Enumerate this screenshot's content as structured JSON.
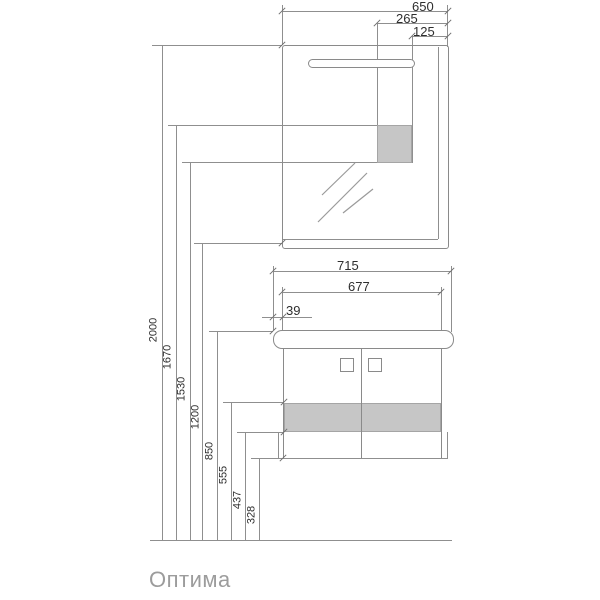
{
  "title": "Оптима",
  "colors": {
    "line": "#8f8f8f",
    "tick": "#6e6e6e",
    "fill_gray": "#c6c6c6",
    "dim_text": "#2e2e2e",
    "title_text": "#9c9c9c",
    "background": "#ffffff"
  },
  "mirror_cabinet": {
    "width_dims": [
      {
        "label": "650"
      },
      {
        "label": "265"
      },
      {
        "label": "125"
      }
    ]
  },
  "vanity": {
    "width_dims": [
      {
        "label": "715"
      },
      {
        "label": "677"
      },
      {
        "label": "39"
      }
    ]
  },
  "height_dims": [
    {
      "label": "2000"
    },
    {
      "label": "1670"
    },
    {
      "label": "1530"
    },
    {
      "label": "1200"
    },
    {
      "label": "850"
    },
    {
      "label": "555"
    },
    {
      "label": "437"
    },
    {
      "label": "328"
    }
  ]
}
